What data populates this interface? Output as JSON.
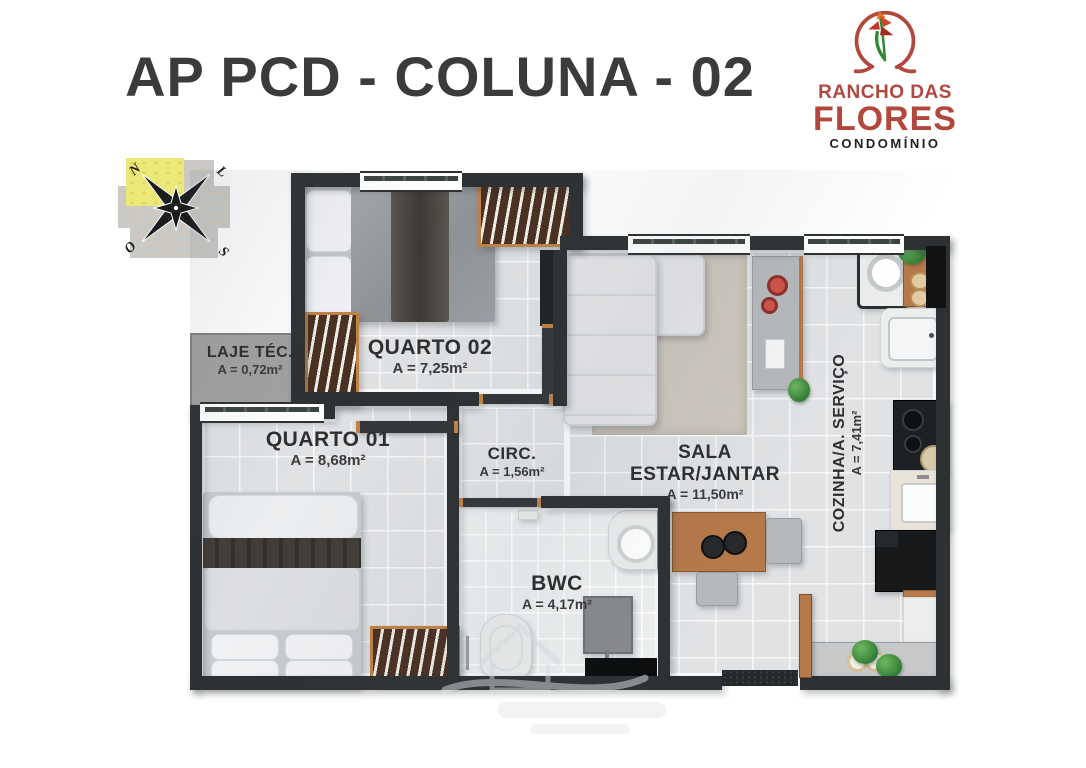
{
  "title": "AP PCD - COLUNA - 02",
  "logo": {
    "line1": "RANCHO DAS",
    "line2": "FLORES",
    "line3": "CONDOMÍNIO"
  },
  "compass": {
    "north": "N",
    "east": "L",
    "west": "O",
    "south": "S"
  },
  "rooms": {
    "laje": {
      "name": "LAJE TÉC.",
      "area": "A = 0,72m²"
    },
    "quarto02": {
      "name": "QUARTO 02",
      "area": "A = 7,25m²"
    },
    "quarto01": {
      "name": "QUARTO 01",
      "area": "A = 8,68m²"
    },
    "circ": {
      "name": "CIRC.",
      "area": "A = 1,56m²"
    },
    "sala": {
      "name": "SALA ESTAR/JANTAR",
      "area": "A = 11,50m²"
    },
    "bwc": {
      "name": "BWC",
      "area": "A = 4,17m²"
    },
    "cozinha": {
      "name": "COZINHA/A. SERVIÇO",
      "area": "A = 7,41m²"
    }
  },
  "colors": {
    "brand_red": "#b2473e",
    "wall": "#2e3133",
    "floor_tile": "#e0e2e4",
    "wood": "#b5794a",
    "key_highlight": "#ece878"
  }
}
